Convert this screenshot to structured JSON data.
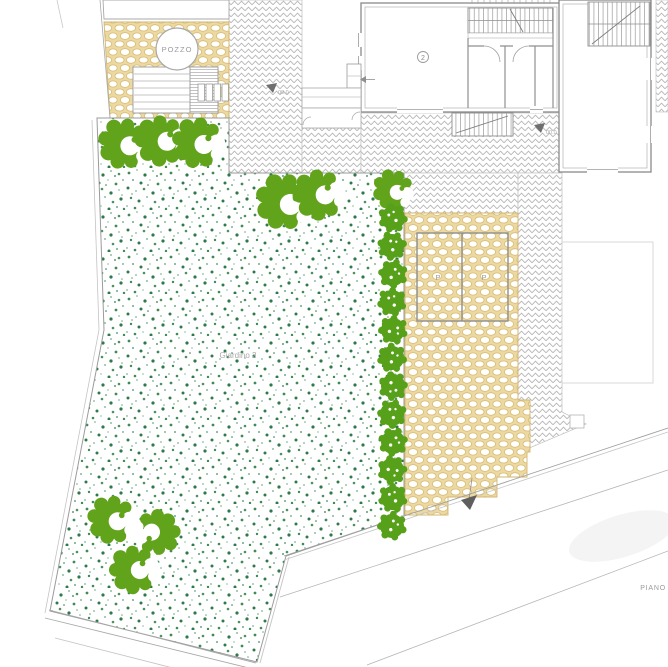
{
  "drawing_labels": {
    "well": "POZZO",
    "garden": "Giardino 2",
    "room_number": "2",
    "parking_stall_left": "P",
    "parking_stall_right": "P",
    "elevation_marker_courtyard_left": "00.0",
    "elevation_marker_courtyard_right": "00.0",
    "street": "PIANO"
  },
  "colors": {
    "cobblestone_fill": "#ecd9a2",
    "cobblestone_outline": "#d8bb72",
    "paving_hatch_grey": "#b8b8b8",
    "lawn_speckle_dark": "#2f7a4a",
    "lawn_speckle_light": "#9fc5a8",
    "shrub_green": "#61a41c",
    "tree_green": "#56a01a",
    "wall_grey": "#8f8f8f",
    "label_grey": "#9a9a9a"
  }
}
